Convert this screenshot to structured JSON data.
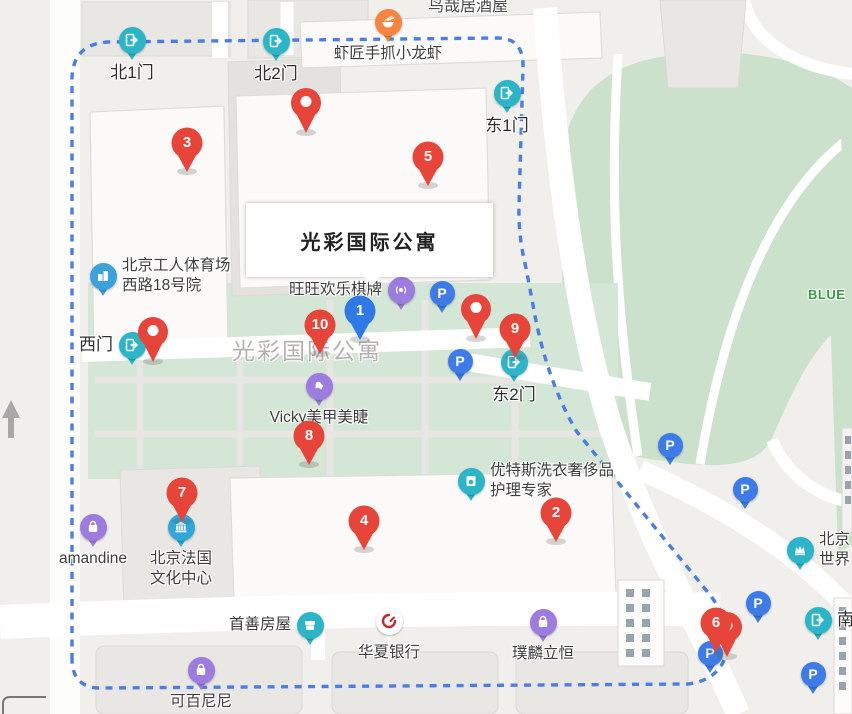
{
  "map": {
    "area_label": "光彩国际公寓",
    "info_box": "光彩国际公寓",
    "izakaya_label": "鸟哉居酒屋",
    "park_label": "BLUE",
    "colors": {
      "marker_red": "#e8453a",
      "marker_blue": "#2e79e6",
      "gate_teal": "#2bb5c9",
      "parking_blue": "#3d7ce8",
      "poi_purple": "#9d7ce0",
      "poi_blue": "#3ba3dc",
      "poi_orange": "#f8853e",
      "poi_teal": "#2bb5c9",
      "bank_red": "#c8252c",
      "boundary_blue": "#4b7de6",
      "park_green": "#cbe1cb",
      "compound_green": "#d4e6d5"
    }
  },
  "markers": [
    {
      "n": "1",
      "x": 360,
      "y": 311,
      "variant": "blue"
    },
    {
      "n": "2",
      "x": 556,
      "y": 513
    },
    {
      "n": "3",
      "x": 187,
      "y": 143
    },
    {
      "n": "4",
      "x": 364,
      "y": 521
    },
    {
      "n": "5",
      "x": 428,
      "y": 157
    },
    {
      "n": "6",
      "x": 716,
      "y": 623
    },
    {
      "n": "7",
      "x": 182,
      "y": 493
    },
    {
      "n": "8",
      "x": 309,
      "y": 436
    },
    {
      "n": "9",
      "x": 515,
      "y": 329
    },
    {
      "n": "10",
      "x": 320,
      "y": 325
    }
  ],
  "plain_pins": [
    {
      "x": 306,
      "y": 101
    },
    {
      "x": 476,
      "y": 307
    },
    {
      "x": 153,
      "y": 330
    },
    {
      "x": 727,
      "y": 625
    }
  ],
  "gates": [
    {
      "label": "北1门",
      "x": 132,
      "y": 40,
      "lp": "below"
    },
    {
      "label": "北2门",
      "x": 276,
      "y": 41,
      "lp": "below"
    },
    {
      "label": "东1门",
      "x": 507,
      "y": 93,
      "lp": "below"
    },
    {
      "label": "西门",
      "x": 132,
      "y": 345,
      "lp": "left"
    },
    {
      "label": "东2门",
      "x": 514,
      "y": 362,
      "lp": "below"
    },
    {
      "label": "南",
      "x": 818,
      "y": 620,
      "lp": "right"
    }
  ],
  "parking": [
    {
      "g": "P",
      "x": 442,
      "y": 293
    },
    {
      "g": "P",
      "x": 460,
      "y": 361
    },
    {
      "g": "P",
      "x": 670,
      "y": 445
    },
    {
      "g": "P",
      "x": 745,
      "y": 489
    },
    {
      "g": "P",
      "x": 758,
      "y": 603
    },
    {
      "g": "P",
      "x": 710,
      "y": 653
    },
    {
      "g": "P",
      "x": 813,
      "y": 674
    }
  ],
  "pois": [
    {
      "icon": "food",
      "label": "虾匠手抓小龙虾",
      "x": 388,
      "y": 22,
      "lp": "below",
      "color": "#f8853e"
    },
    {
      "icon": "building",
      "label": "北京工人体育场\n西路18号院",
      "x": 103,
      "y": 276,
      "lp": "right",
      "color": "#3ba3dc"
    },
    {
      "icon": "game",
      "label": "旺旺欢乐棋牌",
      "x": 401,
      "y": 290,
      "lp": "left",
      "color": "#9d7ce0"
    },
    {
      "icon": "beauty",
      "label": "Vicky美甲美睫",
      "x": 319,
      "y": 386,
      "lp": "below",
      "color": "#9d7ce0"
    },
    {
      "icon": "laundry",
      "label": "优特斯洗衣奢侈品\n护理专家",
      "x": 471,
      "y": 481,
      "lp": "right",
      "color": "#2bb5c9"
    },
    {
      "icon": "museum",
      "label": "北京法国\n文化中心",
      "x": 181,
      "y": 527,
      "lp": "below",
      "color": "#2fa7d9"
    },
    {
      "icon": "bag",
      "label": "amandine",
      "x": 93,
      "y": 527,
      "lp": "below",
      "color": "#9d7ce0"
    },
    {
      "icon": "store",
      "label": "首善房屋",
      "x": 310,
      "y": 625,
      "lp": "left",
      "color": "#2bb5c9"
    },
    {
      "icon": "bank",
      "label": "华夏银行",
      "x": 389,
      "y": 621,
      "lp": "below",
      "color": "#ffffff"
    },
    {
      "icon": "bag",
      "label": "璞麟立恒",
      "x": 543,
      "y": 622,
      "lp": "below",
      "color": "#9d7ce0"
    },
    {
      "icon": "bag",
      "label": "可百尼尼",
      "x": 201,
      "y": 670,
      "lp": "below",
      "color": "#9d7ce0"
    },
    {
      "icon": "landmark",
      "label": "北京\n世界",
      "x": 800,
      "y": 550,
      "lp": "right",
      "color": "#2bb5c9"
    }
  ],
  "building_labels": [
    {
      "label": "3号楼",
      "x": 190,
      "y": 175
    },
    {
      "label": "4号楼",
      "x": 431,
      "y": 190
    },
    {
      "label": "1号楼",
      "x": 363,
      "y": 556
    },
    {
      "label": "2号楼",
      "x": 556,
      "y": 546
    }
  ]
}
